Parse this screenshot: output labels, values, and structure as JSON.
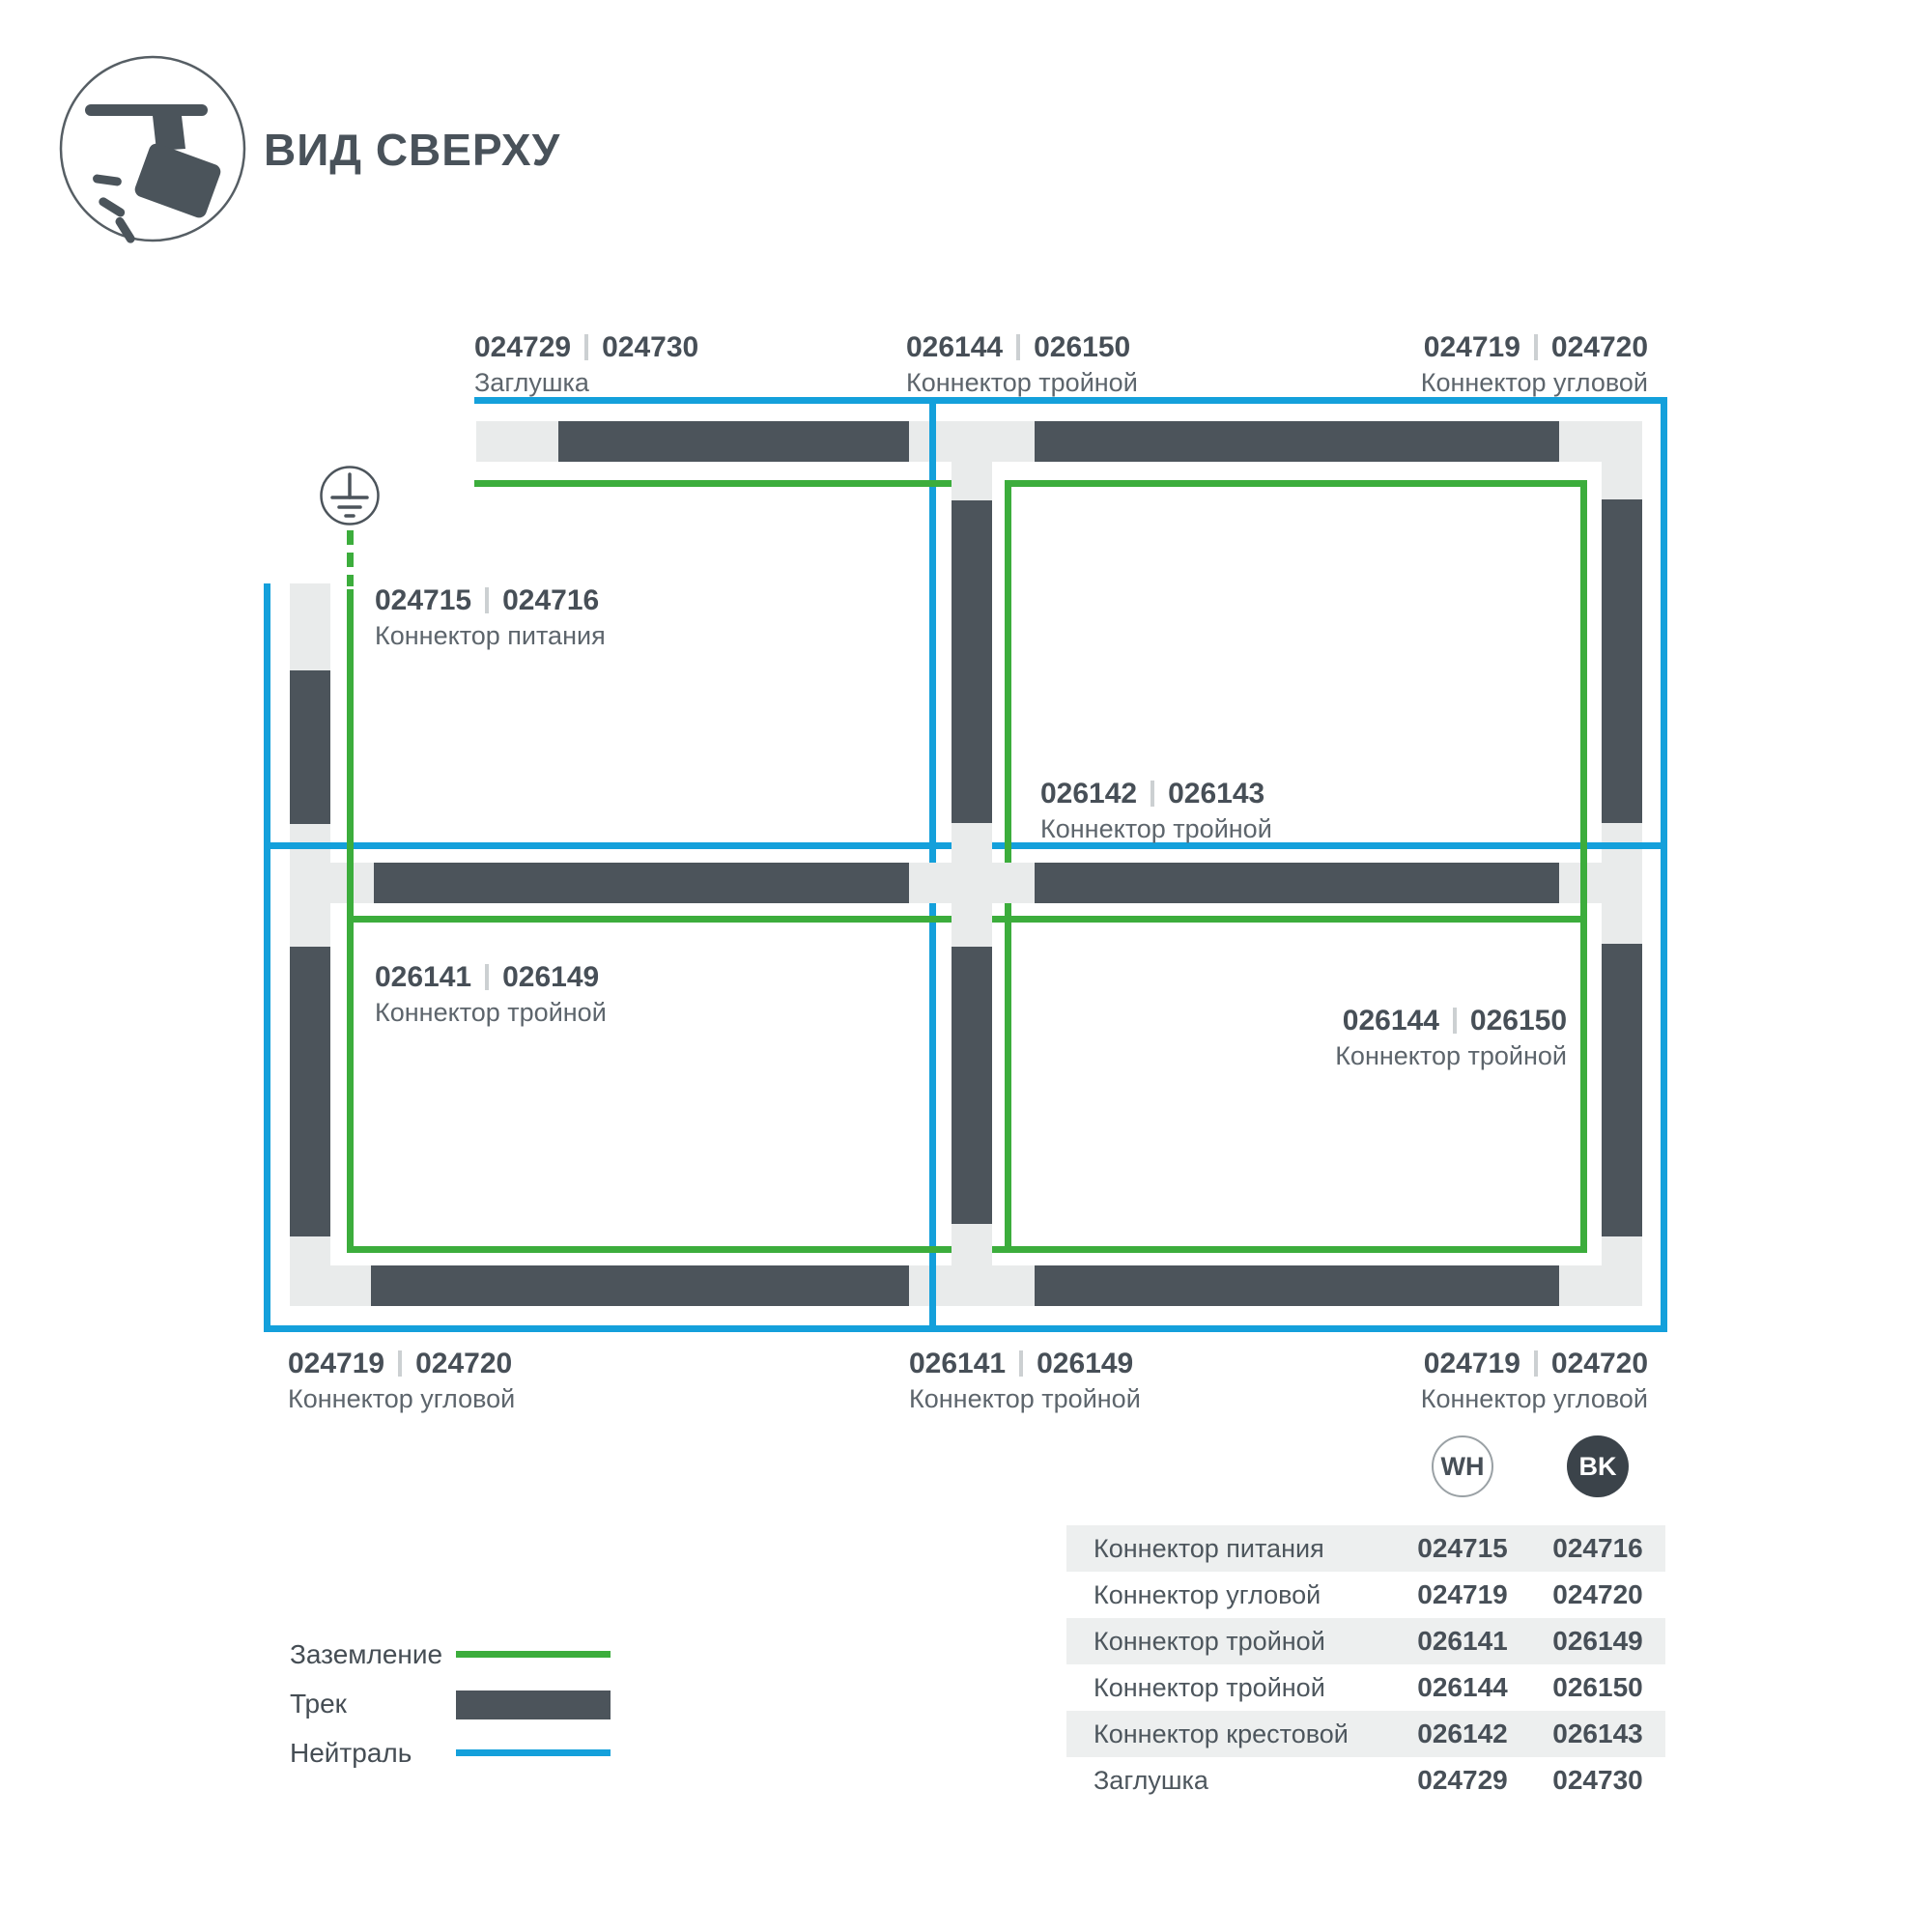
{
  "header": {
    "title": "ВИД СВЕРХУ"
  },
  "diagram": {
    "labels": [
      {
        "pos": "top-left",
        "code_wh": "024729",
        "code_bk": "024730",
        "name": "Заглушка"
      },
      {
        "pos": "top-center",
        "code_wh": "026144",
        "code_bk": "026150",
        "name": "Коннектор тройной"
      },
      {
        "pos": "top-right",
        "code_wh": "024719",
        "code_bk": "024720",
        "name": "Коннектор угловой"
      },
      {
        "pos": "power-feed",
        "code_wh": "024715",
        "code_bk": "024716",
        "name": "Коннектор питания"
      },
      {
        "pos": "center-cross",
        "code_wh": "026142",
        "code_bk": "026143",
        "name": "Коннектор тройной"
      },
      {
        "pos": "mid-left",
        "code_wh": "026141",
        "code_bk": "026149",
        "name": "Коннектор тройной"
      },
      {
        "pos": "mid-right",
        "code_wh": "026144",
        "code_bk": "026150",
        "name": "Коннектор тройной"
      },
      {
        "pos": "bottom-left",
        "code_wh": "024719",
        "code_bk": "024720",
        "name": "Коннектор угловой"
      },
      {
        "pos": "bottom-center",
        "code_wh": "026141",
        "code_bk": "026149",
        "name": "Коннектор тройной"
      },
      {
        "pos": "bottom-right",
        "code_wh": "024719",
        "code_bk": "024720",
        "name": "Коннектор угловой"
      }
    ]
  },
  "legend": {
    "items": [
      {
        "label": "Заземление",
        "swatch": "green-line"
      },
      {
        "label": "Трек",
        "swatch": "dark-bar"
      },
      {
        "label": "Нейтраль",
        "swatch": "blue-line"
      }
    ]
  },
  "parts_table": {
    "col_wh": "WH",
    "col_bk": "BK",
    "rows": [
      {
        "name": "Коннектор питания",
        "wh": "024715",
        "bk": "024716"
      },
      {
        "name": "Коннектор угловой",
        "wh": "024719",
        "bk": "024720"
      },
      {
        "name": "Коннектор тройной",
        "wh": "026141",
        "bk": "026149"
      },
      {
        "name": "Коннектор тройной",
        "wh": "026144",
        "bk": "026150"
      },
      {
        "name": "Коннектор крестовой",
        "wh": "026142",
        "bk": "026143"
      },
      {
        "name": "Заглушка",
        "wh": "024729",
        "bk": "024730"
      }
    ]
  },
  "colors": {
    "track_dark": "#4c545b",
    "track_light": "#e9ebeb",
    "neutral_blue": "#14a0db",
    "ground_green": "#3cad3c",
    "text_primary": "#474f57",
    "text_secondary": "#5d656c"
  }
}
